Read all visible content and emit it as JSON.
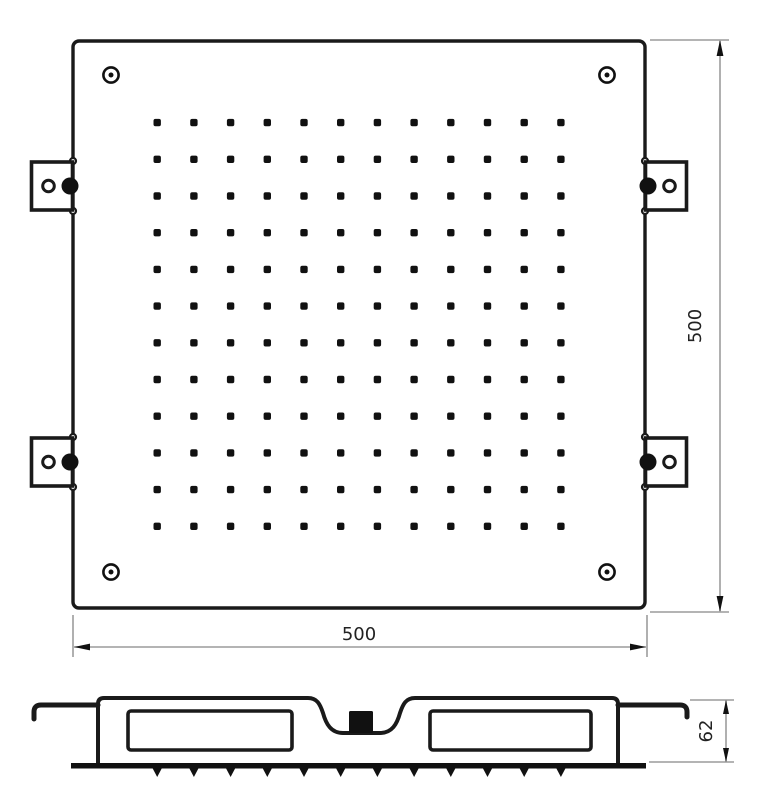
{
  "drawing": {
    "dimensions": {
      "plate_width": "500",
      "plate_height": "500",
      "profile_height": "62"
    },
    "nozzle_grid": {
      "rows": 12,
      "cols": 12
    },
    "corner_screw_count": 4,
    "mounting_bracket_count": 4,
    "colors": {
      "line": "#1a1a1a",
      "dimension_line": "#9c9c9c",
      "dimension_text": "#222222",
      "background": "#ffffff"
    }
  }
}
